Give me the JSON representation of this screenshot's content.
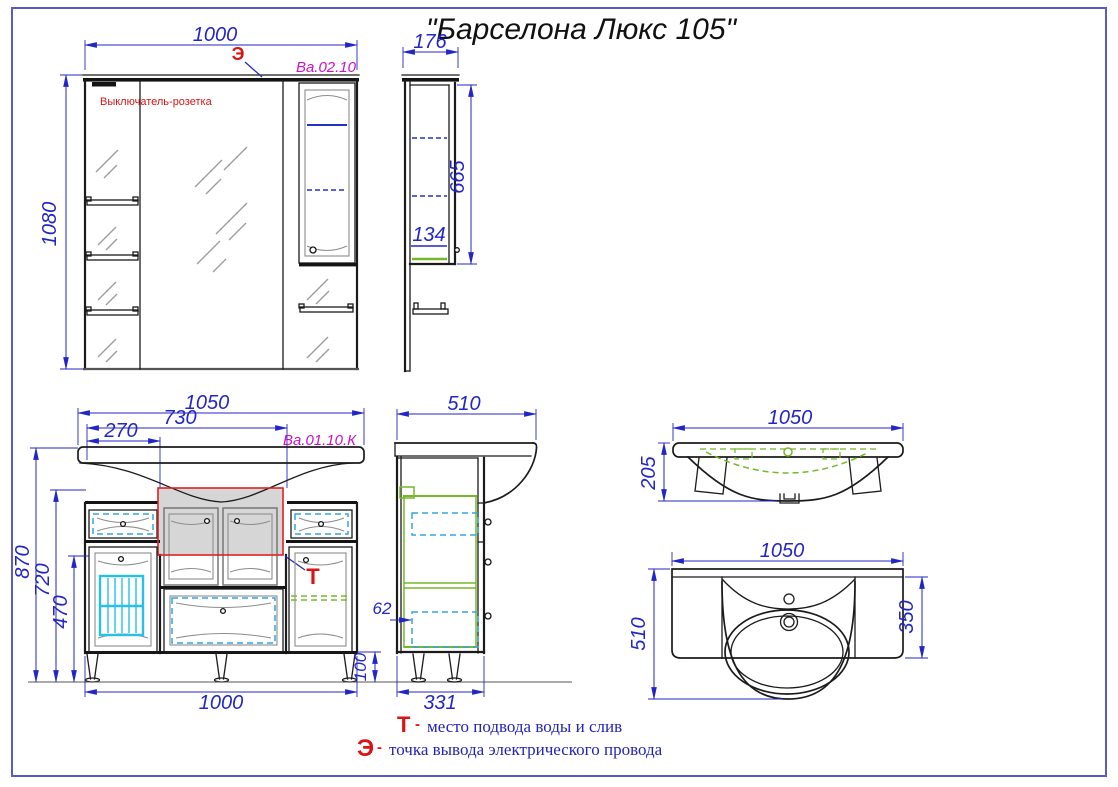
{
  "title": "\"Барселона Люкс 105\"",
  "colors": {
    "dimension_blue": "#2326c6",
    "part_label_magenta": "#c911c9",
    "callout_red": "#da1414",
    "hidden_green": "#76b82a",
    "fitting_cyan": "#33a6dd",
    "shelf_blue": "#2330cc",
    "outline_black": "#1b1b1b",
    "shade_gray": "#d6d6d6",
    "page_border": "#5a5ac8"
  },
  "legend": {
    "t_symbol": "Т",
    "t_sep": "-",
    "t_text": "место подвода воды и слив",
    "e_symbol": "Э",
    "e_sep": "-",
    "e_text": "точка вывода электрического провода"
  },
  "mirror_front": {
    "label": "Ва.02.10",
    "electric_callout": "Э",
    "switch_label": "Выключатель-розетка",
    "dim_width": "1000",
    "dim_height": "1080"
  },
  "mirror_side": {
    "dim_depth": "176",
    "dim_height": "665",
    "dim_shelf": "134"
  },
  "vanity_front": {
    "label": "Ва.01.10.К",
    "water_callout": "Т",
    "dim_top_width": "1050",
    "dim_mid_width": "730",
    "dim_small_width": "270",
    "dim_total_height": "870",
    "dim_body_height": "720",
    "dim_door_height": "470",
    "dim_bottom_width": "1000",
    "dim_leg_height": "100"
  },
  "vanity_side": {
    "dim_depth": "510",
    "dim_drawer_offset": "62",
    "dim_bottom_depth": "331"
  },
  "basin_section": {
    "dim_width": "1050",
    "dim_height": "205"
  },
  "basin_plan": {
    "dim_width": "1050",
    "dim_depth": "510",
    "dim_basin_depth": "350"
  }
}
